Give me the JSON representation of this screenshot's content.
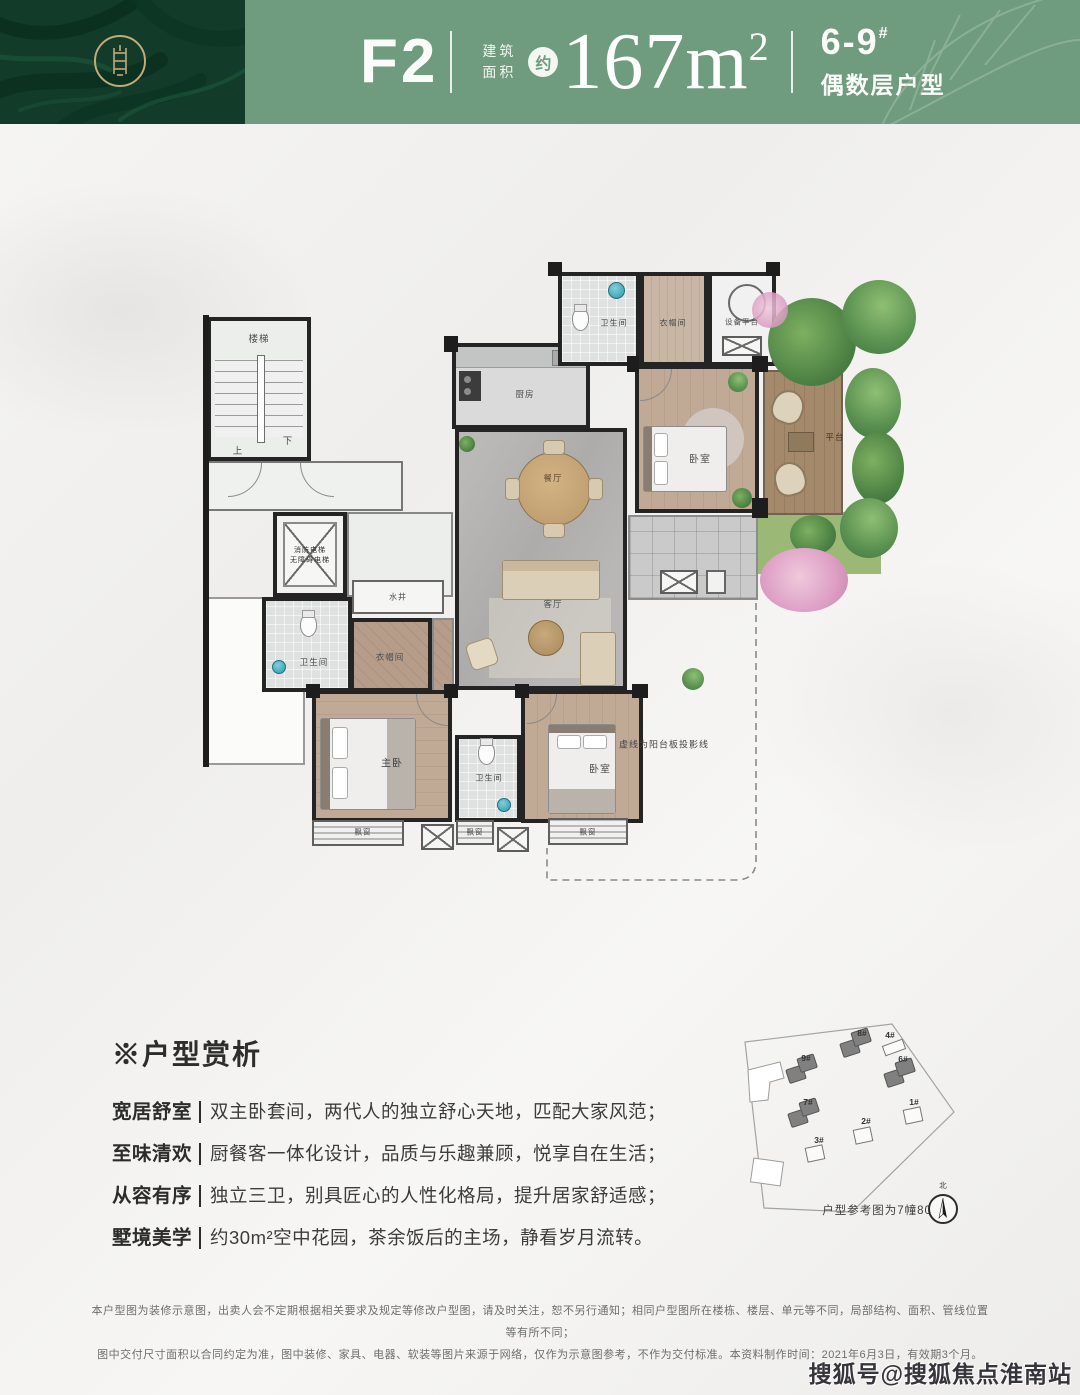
{
  "header": {
    "unit_code": "F2",
    "area_label_1": "建筑",
    "area_label_2": "面积",
    "approx": "约",
    "area_value": "167m",
    "area_sup": "2",
    "building_no": "6-9",
    "building_hash": "#",
    "building_label": "偶数层户型",
    "band_color": "#6f9b7e",
    "panel_color": "#123b29",
    "gold_color": "#c2aa79"
  },
  "floorplan": {
    "rooms": {
      "stairs": "楼梯",
      "up": "上",
      "down": "下",
      "elevator_line1": "消防电梯",
      "elevator_line2": "无障碍电梯",
      "shaft": "水井",
      "kitchen": "厨房",
      "dining": "餐厅",
      "living": "客厅",
      "bath_top": "卫生间",
      "cloak_top": "衣帽间",
      "equipment": "设备平台",
      "bedroom_top": "卧室",
      "terrace": "平台",
      "bath_mid": "卫生间",
      "cloak_mid": "衣帽间",
      "master": "主卧",
      "bath_bottom": "卫生间",
      "bedroom_bottom": "卧室",
      "bay1": "飘窗",
      "bay2": "飘窗",
      "bay3": "飘窗",
      "balcony_note": "虚线为阳台板投影线"
    }
  },
  "analysis": {
    "mark": "※",
    "title": "户型赏析",
    "items": [
      {
        "label": "宽居舒室",
        "text": "双主卧套间，两代人的独立舒心天地，匹配大家风范；"
      },
      {
        "label": "至味清欢",
        "text": "厨餐客一体化设计，品质与乐趣兼顾，悦享自在生活；"
      },
      {
        "label": "从容有序",
        "text": "独立三卫，别具匠心的人性化格局，提升居家舒适感；"
      },
      {
        "label": "墅境美学",
        "text": "约30m²空中花园，茶余饭后的主场，静看岁月流转。"
      }
    ]
  },
  "siteplan": {
    "buildings": [
      {
        "id": "9#"
      },
      {
        "id": "8#"
      },
      {
        "id": "4#"
      },
      {
        "id": "6#"
      },
      {
        "id": "7#"
      },
      {
        "id": "1#"
      },
      {
        "id": "2#"
      },
      {
        "id": "3#"
      }
    ],
    "caption": "户型参考图为7幢801室",
    "compass_label": "北"
  },
  "disclaimer": {
    "line1": "本户型图为装修示意图，出卖人会不定期根据相关要求及规定等修改户型图，请及时关注，恕不另行通知；相同户型图所在楼栋、楼层、单元等不同，局部结构、面积、管线位置等有所不同；",
    "line2": "图中交付尺寸面积以合同约定为准，图中装修、家具、电器、软装等图片来源于网络，仅作为示意图参考，不作为交付标准。本资料制作时间：2021年6月3日，有效期3个月。"
  },
  "watermark": "搜狐号@搜狐焦点淮南站"
}
